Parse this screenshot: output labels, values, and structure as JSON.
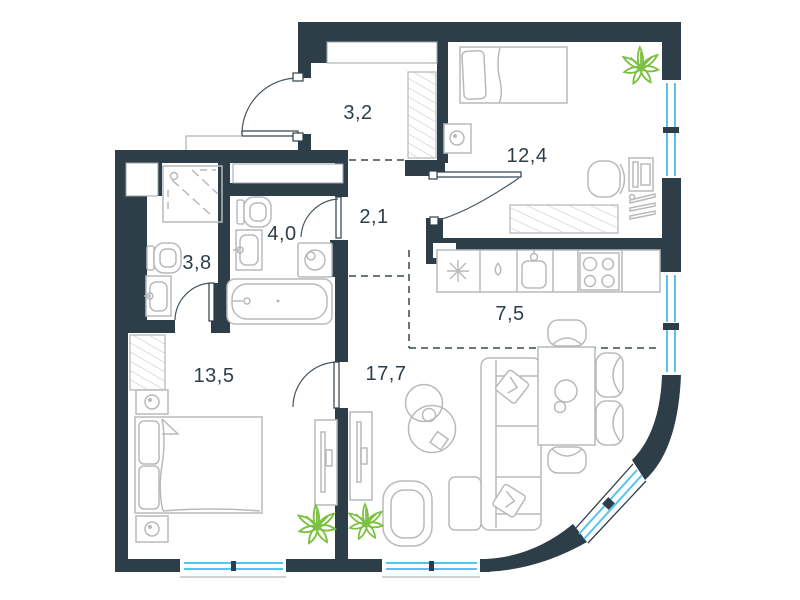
{
  "floor_plan": {
    "rooms": [
      {
        "name": "entry-hall",
        "area": "3,2"
      },
      {
        "name": "bedroom-top",
        "area": "12,4"
      },
      {
        "name": "corridor",
        "area": "2,1"
      },
      {
        "name": "bathroom",
        "area": "4,0"
      },
      {
        "name": "shower-room",
        "area": "3,8"
      },
      {
        "name": "kitchen",
        "area": "7,5"
      },
      {
        "name": "bedroom-bottom",
        "area": "13,5"
      },
      {
        "name": "living-room",
        "area": "17,7"
      }
    ],
    "colors": {
      "wall": "#2d3e48",
      "window": "#57c3f1",
      "plant": "#7cc142",
      "furniture_line": "#b7babc",
      "zone_dash": "#35484f",
      "floor": "#ffffff"
    }
  }
}
